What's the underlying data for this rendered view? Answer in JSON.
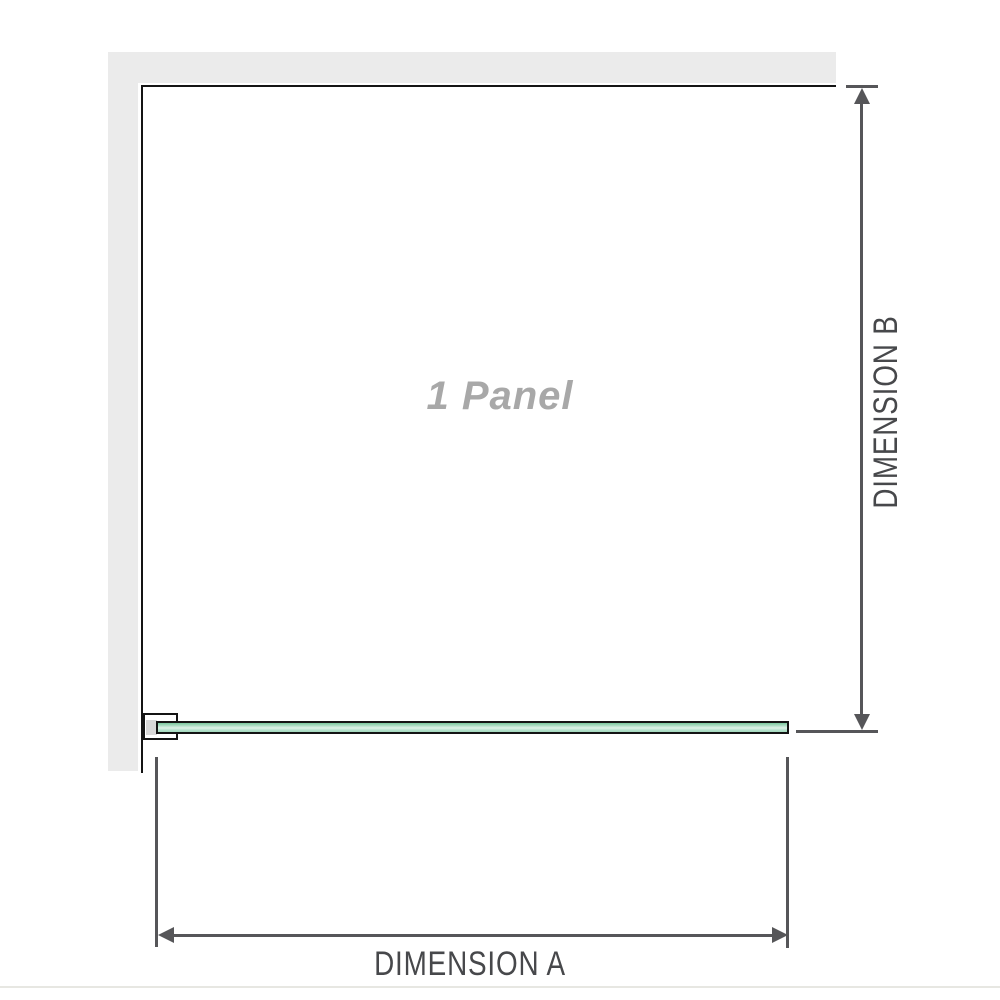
{
  "diagram": {
    "panel_label": "1 Panel",
    "dimension_a_label": "DIMENSION A",
    "dimension_b_label": "DIMENSION B"
  },
  "icons": {
    "dimension_b_top": "arrow-up-icon",
    "dimension_b_bottom": "arrow-down-icon",
    "dimension_a_left": "arrow-left-icon",
    "dimension_a_right": "arrow-right-icon"
  },
  "colors": {
    "wall_gray": "#ebebeb",
    "outline_black": "#141414",
    "line_gray": "#565659",
    "label_gray": "#47484b",
    "panel_text_gray": "#a8a8a8",
    "glass_top": "#79c79c",
    "glass_mid": "#dff2e8",
    "glass_low": "#a3d9bd",
    "divider_gray": "#e7e7e2"
  }
}
